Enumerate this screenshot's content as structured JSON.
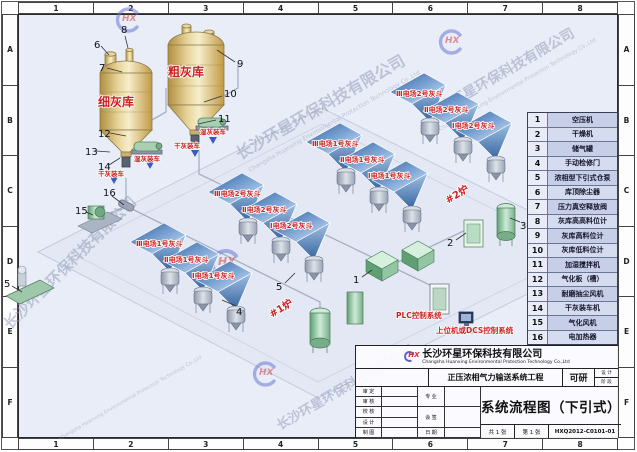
{
  "frame": {
    "top_zones": [
      "1",
      "2",
      "3",
      "4",
      "5",
      "6",
      "7",
      "8"
    ],
    "bottom_zones": [
      "1",
      "2",
      "3",
      "4",
      "5",
      "6",
      "7",
      "8"
    ],
    "left_zones": [
      "A",
      "B",
      "C",
      "D",
      "E",
      "F"
    ],
    "right_zones": [
      "A",
      "B",
      "C",
      "D",
      "E",
      "F"
    ]
  },
  "legend": {
    "rows": [
      {
        "no": "1",
        "name": "空压机"
      },
      {
        "no": "2",
        "name": "干燥机"
      },
      {
        "no": "3",
        "name": "储气罐"
      },
      {
        "no": "4",
        "name": "手动检修门"
      },
      {
        "no": "5",
        "name": "浓相型下引式仓泵"
      },
      {
        "no": "6",
        "name": "库顶除尘器"
      },
      {
        "no": "7",
        "name": "压力真空释放阀"
      },
      {
        "no": "8",
        "name": "灰库高高料位计"
      },
      {
        "no": "9",
        "name": "灰库高料位计"
      },
      {
        "no": "10",
        "name": "灰库低料位计"
      },
      {
        "no": "11",
        "name": "加湿搅拌机"
      },
      {
        "no": "12",
        "name": "气化板（槽）"
      },
      {
        "no": "13",
        "name": "耐磨抽尘风机"
      },
      {
        "no": "14",
        "name": "干灰装车机"
      },
      {
        "no": "15",
        "name": "气化风机"
      },
      {
        "no": "16",
        "name": "电加热器"
      }
    ]
  },
  "diagram": {
    "silo_fine": "细灰库",
    "silo_coarse": "粗灰库",
    "dry_loading": "干灰装车",
    "wet_loading": "湿灰装车",
    "boiler1": "#1炉",
    "boiler2": "#2炉",
    "esp": {
      "b1r1": [
        "Ⅲ电场1号灰斗",
        "Ⅱ电场1号灰斗",
        "Ⅰ电场1号灰斗"
      ],
      "b1r2": [
        "Ⅲ电场2号灰斗",
        "Ⅱ电场2号灰斗",
        "Ⅰ电场2号灰斗"
      ],
      "b2r1": [
        "Ⅲ电场1号灰斗",
        "Ⅱ电场1号灰斗",
        "Ⅰ电场1号灰斗"
      ],
      "b2r2": [
        "Ⅲ电场2号灰斗",
        "Ⅱ电场2号灰斗",
        "Ⅰ电场2号灰斗"
      ]
    },
    "plc": "PLC控制系统",
    "dcs": "上位机或DCS控制系统",
    "callouts": {
      "c1": "1",
      "c2": "2",
      "c3": "3",
      "c4": "4",
      "c5": "5",
      "c6": "6",
      "c7": "7",
      "c8": "8",
      "c9": "9",
      "c10": "10",
      "c11": "11",
      "c12": "12",
      "c13": "13",
      "c14": "14",
      "c15": "15",
      "c16": "16"
    }
  },
  "title_block": {
    "logo": "HX",
    "company_cn": "长沙环星环保科技有限公司",
    "company_en": "Changsha Huanxing Environmental Protection Technology Co.,Ltd",
    "project": "正压浓相气力输送系统工程",
    "stage_value": "可研",
    "stage_label_top": "设 计",
    "stage_label_bottom": "阶 段",
    "drawing_title": "系统流程图（下引式）",
    "drawing_no": "HXQ2012-C0101-01",
    "row_labels": [
      "审 定",
      "审 核",
      "校 核",
      "设 计",
      "制 图"
    ],
    "mid_labels": [
      "专 业",
      "会 签",
      "日 期"
    ],
    "sheet_total": "共 1 张",
    "sheet_no": "第 1 张"
  },
  "watermark": {
    "logo": "HX",
    "cn": "长沙环星环保科技有限公司",
    "en": "Changsha Huanxing Environmental Protection Technology Co.,Ltd"
  },
  "colors": {
    "label_red": "#cc2222",
    "esp_blue_dark": "#2f5f9a",
    "esp_blue_light": "#dbe8f6",
    "silo_gold": "#d9c07a",
    "equipment_green": "#8fc49e",
    "watermark_blue": "#6b79d4"
  }
}
